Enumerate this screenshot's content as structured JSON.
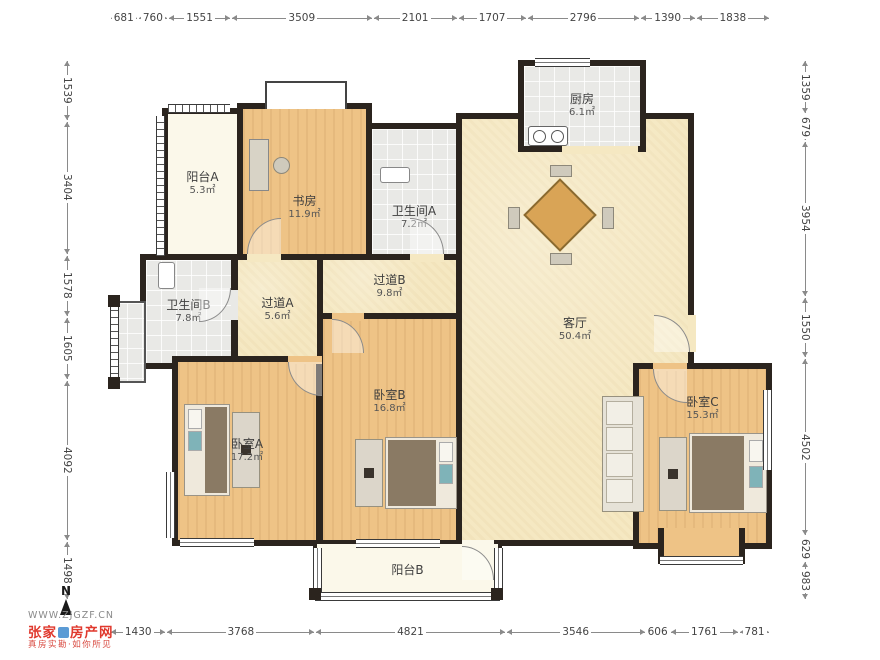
{
  "dimensions": {
    "top": [
      "681",
      "760",
      "1551",
      "3509",
      "2101",
      "1707",
      "2796",
      "1390",
      "1838"
    ],
    "bottom": [
      "1430",
      "3768",
      "4821",
      "3546",
      "606",
      "1761",
      "781"
    ],
    "left": [
      "1539",
      "3404",
      "1578",
      "1605",
      "4092",
      "1498"
    ],
    "right": [
      "1359",
      "679",
      "3954",
      "1550",
      "4502",
      "629",
      "983"
    ]
  },
  "rooms": {
    "balcony_a": {
      "name": "阳台A",
      "area": "5.3㎡"
    },
    "study": {
      "name": "书房",
      "area": "11.9㎡"
    },
    "bathroom_a": {
      "name": "卫生间A",
      "area": "7.2㎡"
    },
    "kitchen": {
      "name": "厨房",
      "area": "6.1㎡"
    },
    "living": {
      "name": "客厅",
      "area": "50.4㎡"
    },
    "bathroom_b": {
      "name": "卫生间B",
      "area": "7.8㎡"
    },
    "hall_a": {
      "name": "过道A",
      "area": "5.6㎡"
    },
    "hall_b": {
      "name": "过道B",
      "area": "9.8㎡"
    },
    "bedroom_a": {
      "name": "卧室A",
      "area": "17.2㎡"
    },
    "bedroom_b": {
      "name": "卧室B",
      "area": "16.8㎡"
    },
    "bedroom_c": {
      "name": "卧室C",
      "area": "15.3㎡"
    },
    "balcony_b": {
      "name": "阳台B",
      "area": ""
    }
  },
  "branding": {
    "north": "N",
    "website": "WWW.ZJGZF.CN",
    "logo_left": "张家",
    "logo_right": "房产网",
    "slogan": "真房实勘·如你所见"
  },
  "colors": {
    "wall": "#2b241e",
    "floor_main": "#f5e8c2",
    "floor_wood": "#eec386",
    "floor_tile": "#e9e9e6",
    "floor_balcony": "#fbf8ea",
    "logo_red": "#e0392e",
    "logo_blue": "#5b9bd5"
  }
}
